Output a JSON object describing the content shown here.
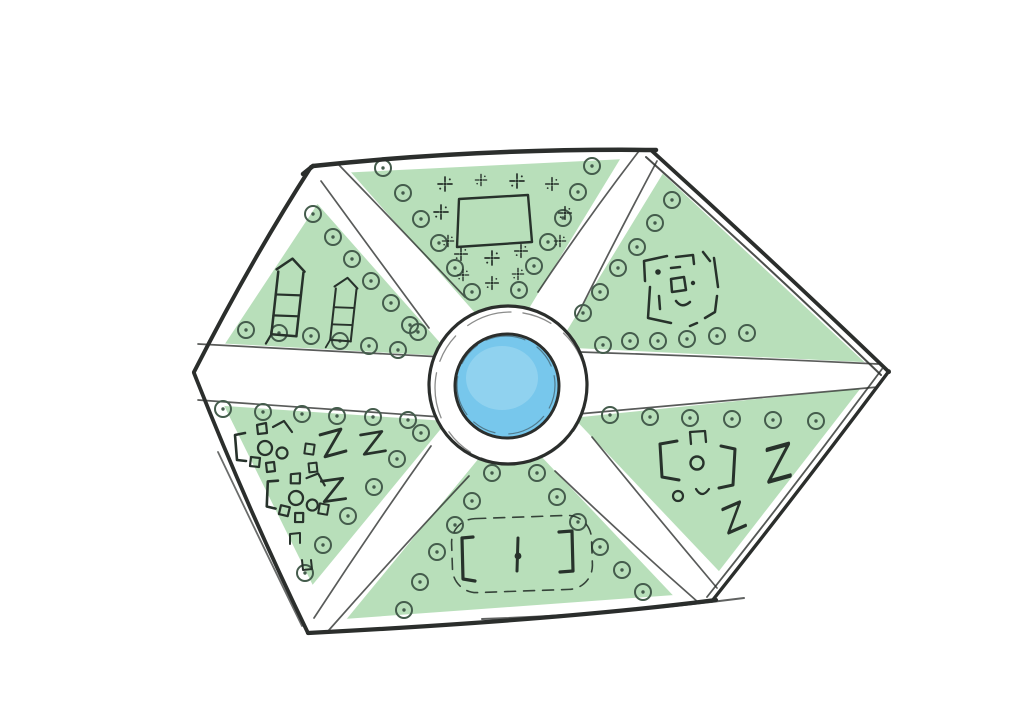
{
  "diagram": {
    "type": "hand-drawn hexagonal park site plan",
    "colors": {
      "paper": "#ffffff",
      "lawn": "#b8dfba",
      "pond": "#77c7ec",
      "pond_highlight": "#a6daf2",
      "ink": "#2b2e2c",
      "tree_ink": "#445c4c",
      "detail_ink": "#27322b"
    },
    "center": {
      "plaza": "circular white plaza ring",
      "water": "round pond"
    },
    "walkways": "six white paths radiating from the central plaza to the hexagon corners",
    "tree_marker": "circle-with-dot",
    "sectors": [
      {
        "id": "north",
        "contents": "square plot surrounded by planting cross marks"
      },
      {
        "id": "north-west",
        "contents": "two arrow-tipped garden beds"
      },
      {
        "id": "north-east",
        "contents": "nested broken-square labyrinth"
      },
      {
        "id": "south-west",
        "contents": "picnic-table clusters and z-shaped benches"
      },
      {
        "id": "south",
        "contents": "sports field with two goals, centre line and dashed boundary"
      },
      {
        "id": "south-east",
        "contents": "picnic-table cluster and z-shaped benches"
      }
    ]
  }
}
